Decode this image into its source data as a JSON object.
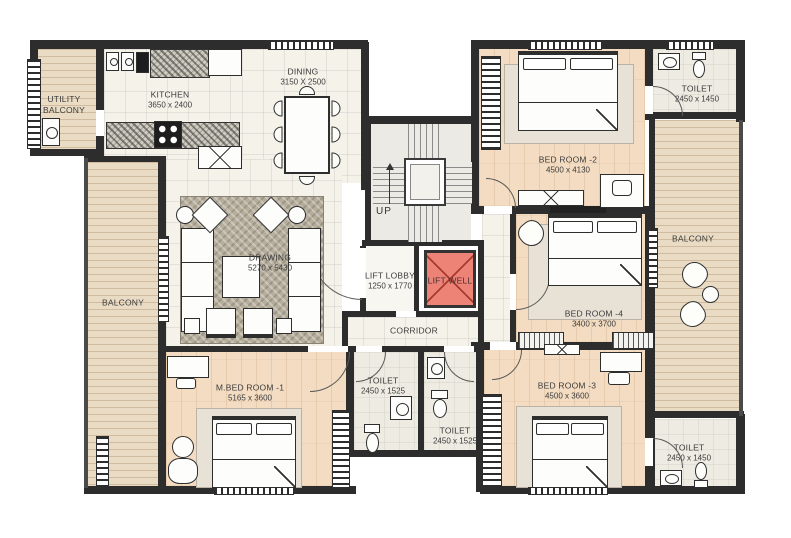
{
  "title": "Apartment floor plan",
  "colors": {
    "wall": "#2d2d2d",
    "tile_floor": "#f4f2e9",
    "wood_floor": "#f3dcc2",
    "balcony_plank": "#eadcc4",
    "rug": "#b6ae9d",
    "lift_well_fill": "#ed8277"
  },
  "rooms": {
    "utility_balcony": {
      "name": "UTILITY BALCONY"
    },
    "kitchen": {
      "name": "KITCHEN",
      "dims": "3650 x 2400"
    },
    "dining": {
      "name": "DINING",
      "dims": "3150 X 2500"
    },
    "drawing": {
      "name": "DRAWING",
      "dims": "5270 x 5430"
    },
    "stairs": {
      "up_label": "UP"
    },
    "lift_lobby": {
      "name": "LIFT LOBBY",
      "dims": "1250 x 1770"
    },
    "lift_well": {
      "name": "LIFT WELL"
    },
    "corridor": {
      "name": "CORRIDOR"
    },
    "bedroom_2": {
      "name": "BED ROOM -2",
      "dims": "4500 x 4130"
    },
    "toilet_top_right": {
      "name": "TOILET",
      "dims": "2450 x 1450"
    },
    "balcony_right": {
      "name": "BALCONY"
    },
    "bedroom_4": {
      "name": "BED ROOM -4",
      "dims": "3400 x 3700"
    },
    "bedroom_3": {
      "name": "BED ROOM -3",
      "dims": "4500 x 3600"
    },
    "toilet_bottom_right": {
      "name": "TOILET",
      "dims": "2450 x 1450"
    },
    "master_bedroom": {
      "name": "M.BED ROOM -1",
      "dims": "5165 x 3600"
    },
    "toilet_mid_left": {
      "name": "TOILET",
      "dims": "2450 x 1525"
    },
    "toilet_mid_right": {
      "name": "TOILET",
      "dims": "2450 x 1525"
    },
    "balcony_left": {
      "name": "BALCONY"
    }
  }
}
